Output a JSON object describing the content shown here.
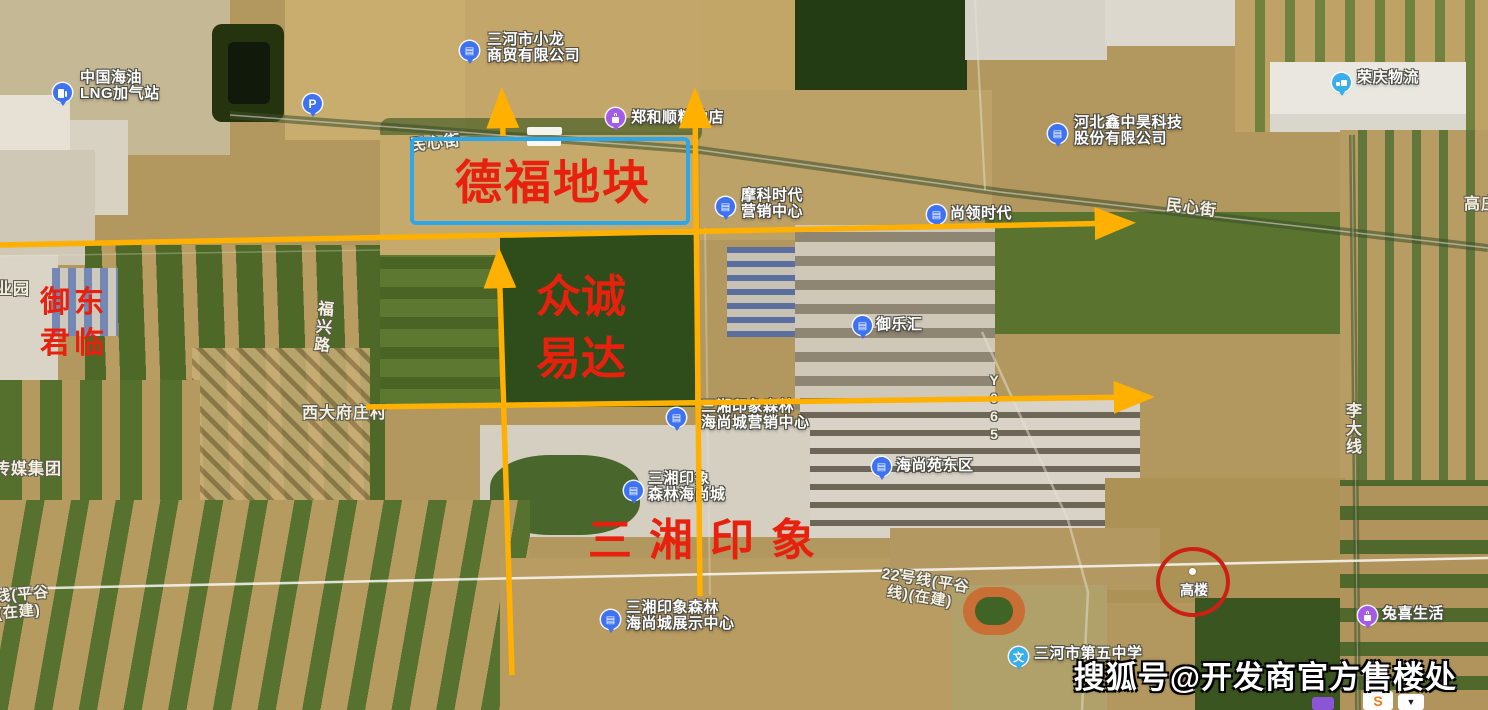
{
  "colors": {
    "annotation_yellow": "#FFB000",
    "annotation_red": "#E8200E",
    "plot_box_blue": "#2BA7EA",
    "circle_red": "#CC2015",
    "poi_blue": "#3D72F2",
    "poi_purple": "#A35BE8",
    "poi_lightblue": "#38AEEC",
    "road_label_white": "#F6F1DE"
  },
  "icons": {
    "building": "▤",
    "parking": "P",
    "school": "文",
    "gas-pump": "css-shape",
    "truck": "css-shape",
    "shopping-bag": "css-shape"
  },
  "pois": [
    {
      "id": "lng-station",
      "lines": [
        "中国海油",
        "LNG加气站"
      ]
    },
    {
      "id": "parking",
      "lines": []
    },
    {
      "id": "xiaolong-trade",
      "lines": [
        "三河市小龙",
        "商贸有限公司"
      ]
    },
    {
      "id": "zhenghe-grain",
      "lines": [
        "郑和顺粮油店"
      ]
    },
    {
      "id": "moke-times",
      "lines": [
        "摩科时代",
        "营销中心"
      ]
    },
    {
      "id": "shangling-times",
      "lines": [
        "尚领时代"
      ]
    },
    {
      "id": "hebei-xinzhonghao",
      "lines": [
        "河北鑫中昊科技",
        "股份有限公司"
      ]
    },
    {
      "id": "rongqing-logistics",
      "lines": [
        "荣庆物流"
      ]
    },
    {
      "id": "yulehui",
      "lines": [
        "御乐汇"
      ]
    },
    {
      "id": "sanxiang-marketing",
      "lines": [
        "三湘印象森林",
        "海尚城营销中心"
      ]
    },
    {
      "id": "haishangyuan-east",
      "lines": [
        "海尚苑东区"
      ]
    },
    {
      "id": "sanxiang-haishang",
      "lines": [
        "三湘印象",
        "森林海尚城"
      ]
    },
    {
      "id": "sanxiang-exhibit",
      "lines": [
        "三湘印象森林",
        "海尚城展示中心"
      ]
    },
    {
      "id": "no5-middle-school",
      "lines": [
        "三河市第五中学"
      ]
    },
    {
      "id": "tuxi-life",
      "lines": [
        "兔喜生活"
      ]
    }
  ],
  "road_labels": {
    "minxin_left": "民心街",
    "minxin_right": "民心街",
    "fuxing_road": "福兴路",
    "y065": "Y065",
    "lida_line": "李大线",
    "xidafu_village": "西大府庄村",
    "chuanmei_group": "传媒集团",
    "yeyuan_partial": "业园",
    "gaozhuang_partial": "高庄",
    "line22_left_1": "线(平谷",
    "line22_left_2": "(在建)",
    "line22_mid_1": "22号线(平谷",
    "line22_mid_2": "线)(在建)"
  },
  "annotations": {
    "plot_box_label": "德福地块",
    "zhongcheng_line1": "众诚",
    "zhongcheng_line2": "易达",
    "sanxiang_big": "三湘印象",
    "yudong_line1": "御东",
    "yudong_line2": "君临",
    "gaolou_circle_label": "高楼"
  },
  "watermark": {
    "text": "搜狐号@开发商官方售楼处"
  },
  "bottom_cut_icons": {
    "s_logo": "S",
    "arrow_glyph": "▼"
  }
}
